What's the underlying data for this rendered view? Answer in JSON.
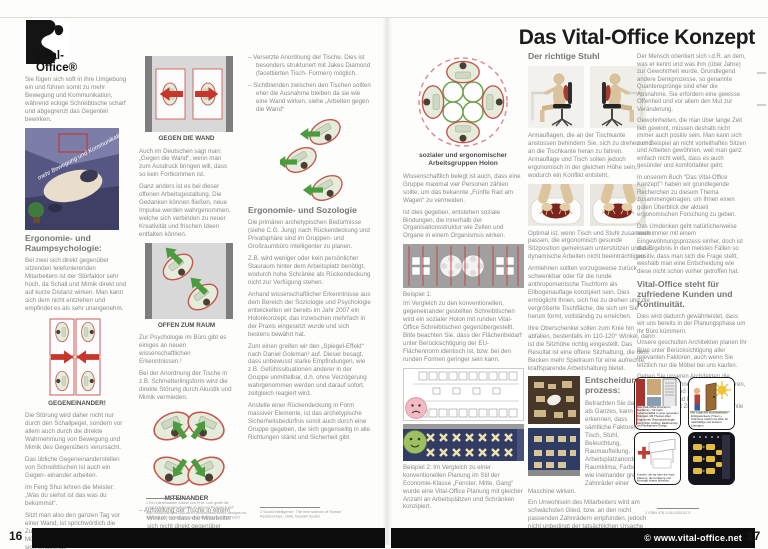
{
  "page16": {
    "page_number": "16",
    "logo_brand": "Vital-Office®",
    "col1": {
      "intro": "Sie fügen sich soft in ihre Umgebung ein und führen somit zu mehr Bewegung und Kommunikation, während eckige Schreibtische scharf und abgegrenzt das Gegenteil bewirken.",
      "img_label": "mehr Bewegung und Kommunikation",
      "heading": "Ergonomie- und Raumpsychologie:",
      "para1": "Bei zwei sich direkt gegenüber sitzenden telefonierenden Mitarbeitern ist der Störfaktor sehr hoch, da Schall und Mimik direkt und auf kurze Distanz wirken. Man kann sich dem nicht entziehen und empfindet es als sehr unangenehm.",
      "caption_gegeneinander": "GEGENEINANDER!",
      "para2": "Die Störung wird daher nicht nur durch den Schallpegel, sondern vor allem auch durch die direkte Wahrnehmung von Bewegung und Mimik des Gegenübers verursacht.",
      "para3": "Das übliche Gegeneinanderstellen von Schreibtischen ist auch ein Gegen- einander arbeiten.",
      "para4": "Im Feng Shui lehren die Meister: „Was du siehst ist das was du bekommst“.",
      "para5": "Sitzt man also den ganzen Tag vor einer Wand, ist sprichwörtlich die Zukunft blockiert. Der Geist hat keine Möglichkeit sich zu entfalten und fühlt sich eingeengt."
    },
    "col2": {
      "caption_wand": "GEGEN DIE WAND",
      "para1": "Auch im Deutschen sagt man: „Gegen die Wand“, wenn man zum Ausdruck bringen will, dass so kein Fortkommen ist.",
      "para2": "Ganz anders ist es bei dieser offenen Arbeitsgestaltung. Die Gedanken können fließen, neue Impulse werden wahrgenommen, welche sich verbinden zu neuer Kreativität und frischen Ideen entfalten können.",
      "caption_offen": "OFFEN ZUM RAUM",
      "para3": "Zur Psychologie im Büro gibt es einiges an neuen wissenschaftlichen Erkenntnissen.¹",
      "para4": "Bei der Anordnung der Tische in z.B. Schmetterlingsform wird die direkte Störung durch Akustik und Mimik vermieden.",
      "caption_miteinander": "MITEINANDER",
      "bullet": "–  Aufstellung der Tische in einem Winkel, so dass die Mitarbeiter sich nicht direkt gegenüber sitzen.",
      "footnote": "1    Ein interessanter Artikel von Prof. Lutz greift die zugrundeliegenden Aspekte in seinem Research auf: http://www.karriere-und-raum.de/business/buero-designs-im-test-hart-und-dominierend-ansichtssache-a-1132571803"
    },
    "col3": {
      "bullet1": "–  Versetzte Anordnung der Tische. Dies ist besonders strukturiert mit Jakes Diamond (facettierten Tisch- Formen) möglich.",
      "bullet2": "–  Sichtblenden zwischen den Tischen sollten eher die Ausnahme bleiben da sie wie eine Wand wirken, siehe „Arbeiten gegen die Wand“",
      "heading": "Ergonomie- und Sozologie",
      "para1": "Die primären archetypischen Bedürfnisse (siehe C.G. Jung) nach Rückendeckung und Privatsphäre sind im Gruppen- und Großraumbüro intelligenter zu planen.",
      "para2": "Z.B. wird weniger oder kein persönlicher Stauraum hinter dem Arbeitsplatz benötigt, wodurch hohe Schränke als Rückendeckung nicht zur Verfügung stehen.",
      "para3": "Anhand wissenschaftlicher Erkenntnisse aus dem Bereich der Soziologie und Psychologie entwickelten wir bereits im Jahr 2007 ein Holonkonzept, das inzwischen mehrfach in der Praxis eingesetzt wurde und sich bestens bewährt hat.",
      "para4": "Zum einen greifen wir den „Spiegel-Effekt“ nach Daniel Goleman² auf. Dieser besagt, dass unbewusst starke Empfindungen, wie z.B. Gefühlssituationen anderer in der Gruppe unmittelbar, d.h. ohne Verzögerung wahrgenommen werden und darauf sofort, zeitgleich reagiert wird.",
      "para5": "Anstelle einer Rückendeckung in Form massiver Elemente, ist das archetypische Sicherheitsbedürfnis somit auch durch eine Gruppe gegeben, die sich gegenseitig in alle Richtungen stärkt und Sicherheit gibt.",
      "footnote": "2    Social Intelligence: The new science of Human Relationships, 2006, Bantam Books"
    }
  },
  "page17": {
    "page_number": "17",
    "title": "Das Vital-Office Konzept",
    "copyright": "© www.vital-office.net",
    "colA": {
      "caption_holon": "sozialer und ergonomischer Arbeitsgruppen Holon",
      "para1": "Wissenschaftlich belegt ist auch, dass eine Gruppe maximal vier Personen zählen sollte, um das bekannte „Fünfte Rad am Wagen“ zu vermeiden.",
      "para2": "Ist dies gegeben, entstehen soziale Bindungen, die innerhalb der Organisationsstruktur wie Zellen und Organe in einem Organismus wirken.",
      "b1_label": "Beispiel 1:",
      "b1_body": "Im Vergleich zu den konventionellen, gegeneinander gestellten Schreibtischen wird ein sozialer Holon mit runden Vital-Office Schreibtischen gegenübergestellt. Bitte beachten Sie, dass der Flächenbedarf unter Berücksichtigung der EU-Flächennorm identisch ist, bzw. bei den runden Formen geringer sein kann.",
      "b2": "Beispiel 2: Im Vergleich zu einer konventionellen Planung im Stil der Economie-Klasse „Fenster, Mitte, Gang“ wurde eine Vital-Office Planung mit gleicher Anzahl an Arbeitsplätzen und Schränken konzipiert."
    },
    "colB": {
      "heading": "Der richtige Stuhl",
      "para1": "Armauflagen, die an der Tischkante anstossen behindern Sie, sich zu drehen und an die Tischkante heran zu fahren. Armauflage und Tisch sollen jedoch ergonomisch in der gleichen Höhe sein, wodurch ein Konflikt entsteht.",
      "para2": "Optimal ist, wenn Tisch und Stuhl zusammen passen, die ergonomisch gesunde Sitzposition gemeinsam unterstützen und das dynamische Arbeiten nicht beeinträchtigen.",
      "para3": "Armlehnen sollten vorzugsweise zurück schwenkbar oder für die runde anthropometrische Tischform als Ellbogenauflage konzipiert sein. Dies ermöglicht Ihnen, sich frei zu drehen und die vergrößerte Tischfläche, die sich um Sie herum formt, vollständig zu erreichen.",
      "para4": "Ihre Oberschenkel sollen zum Knie hin abfallen, bestenfalls im 110-120° Winkel, dann ist die Sitzhöhe richtig eingestellt. Das Resultat ist eine offene Sitzhaltung, die dem Becken mehr Spielraum für eine aufrechte, kraftsparende Arbeitshaltung bietet.",
      "heading2": "Entscheidungs- prozess:",
      "para5": "Betrachten Sie das Büro als Ganzes, kann man erkennen, dass sämtliche Faktoren, wie Tisch, Stuhl, Beleuchtung, Raumaufteilung, Arbeitsplatzanordnung, Raumklima, Farben usw. wie ineinander greifende Zahnräder einer Maschine wirken.",
      "para6": "Ein Unwohlsein des Mitarbeiters wird am schwächsten Glied, bzw. an den nicht passenden Zahnrädern empfunden, jedoch nicht unbedingt der tatsächlichen Ursache zugeordnet."
    },
    "colC": {
      "para1": "Der Mensch orientiert sich i.d.R. an dem, was er kennt und was ihm (über Jahre) zur Gewohnheit wurde. Grundlegend andere Denkprozesse, so genannte Quantensprünge sind eher die Ausnahme. Sie erfordern eine gewisse Offenheit und vor allem den Mut zur Veränderung.",
      "para2": "Gewohnheiten, die man über lange Zeit lieb gewinnt, müssen deshalb nicht immer auch positiv sein. Man kann sich zum Beispiel an nicht vorteilhaftes Sitzen und Arbeiten gewöhnen, weil man ganz einfach nicht weiß, dass es auch gesünder und komfortabler geht.",
      "para3": "In unserem Buch “Das Vital-Office Konzept”¹ haben wir grundlegende Recherchen zu diesem Thema zusammengetragen, um Ihnen einen guten Überblick der aktuell ergonomischen Forschung zu geben.",
      "para4": "Das Umdenken geht natürlicherweise auch immer mit einem Eingewöhnungsprozess einher, doch ist das Ergebnis in den meisten Fällen so positiv, dass man sich die Frage stellt, weshalb man eine Entscheidung wie diese nicht schon vorher getroffen hat.",
      "heading": "Vital-Office steht für zufriedene Kunden und Kontinuität.",
      "para5": "Dies wird dadurch gewährleistet, dass wir uns bereits in der Planungsphase um Ihr Büro kümmern.",
      "para6": "Unsere geschulten Architekten planen Ihr Büro unter Berücksichtigung aller relevanten Faktoren, auch wenn Sie letztlich nur die Möbel bei uns kaufen.",
      "para7": "Geben Sie unseren Architekten die Möglichkeit mit Ihnen zu kommunizieren, Ihre Wünsche und Bedürfnisse aufzunehmen und Ihnen damit Ihr Wohlfühlbüro mit Zufriedenheitsgarantie zu erarbeiten.",
      "panel1_caption": "Das Vital-Office Konzept in Buchform – für mehr Lebensqualität in einer gesunden Bürowelt. Mit Themen über Ergonomie, Raumpsychologie, Feng Shui, Farben, Elektrosmog und intelligentes Design.",
      "panel2_caption": "Die Logik des buchstäblichen Erfolgsdenkens (Türen + Chancen) macht uns offen für nachhaltige und bessere Lösungen.",
      "panel3_caption": "Kunden, die wir über die erste Planung, die Fertigung und Montage hinaus betreuen.",
      "footnote": "1    ISBN 978-3-00-026162-3"
    }
  }
}
